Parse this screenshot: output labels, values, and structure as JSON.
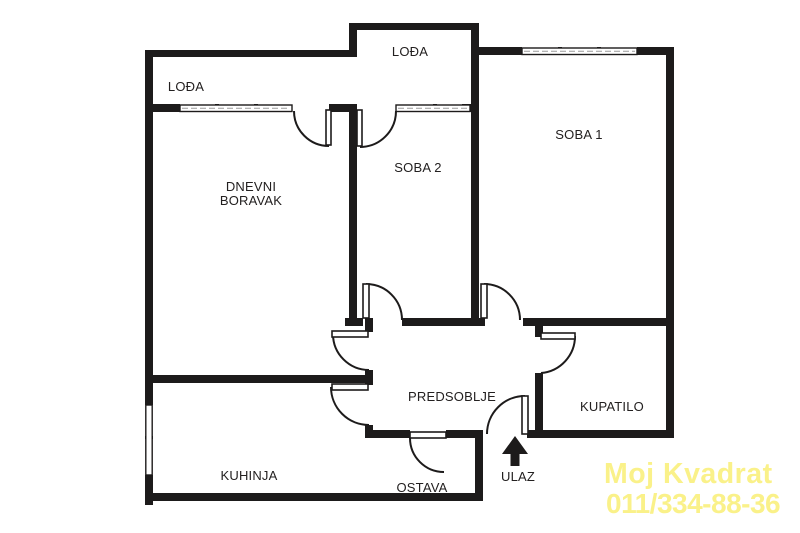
{
  "plan": {
    "type": "apartment-floor-plan",
    "rooms": {
      "loda_left": "LOĐA",
      "loda_top": "LOĐA",
      "soba1": "SOBA 1",
      "soba2": "SOBA 2",
      "dnevni_line1": "DNEVNI",
      "dnevni_line2": "BORAVAK",
      "predsoblje": "PREDSOBLJE",
      "kupatilo": "KUPATILO",
      "kuhinja": "KUHINJA",
      "ostava": "OSTAVA",
      "ulaz": "ULAZ"
    }
  },
  "watermark": {
    "line1": "Moj Kvadrat",
    "line2": "011/334-88-36"
  },
  "colors": {
    "wall": "#1d1b1b",
    "label": "#232020",
    "watermark": "#FAF189",
    "background": "#ffffff"
  }
}
